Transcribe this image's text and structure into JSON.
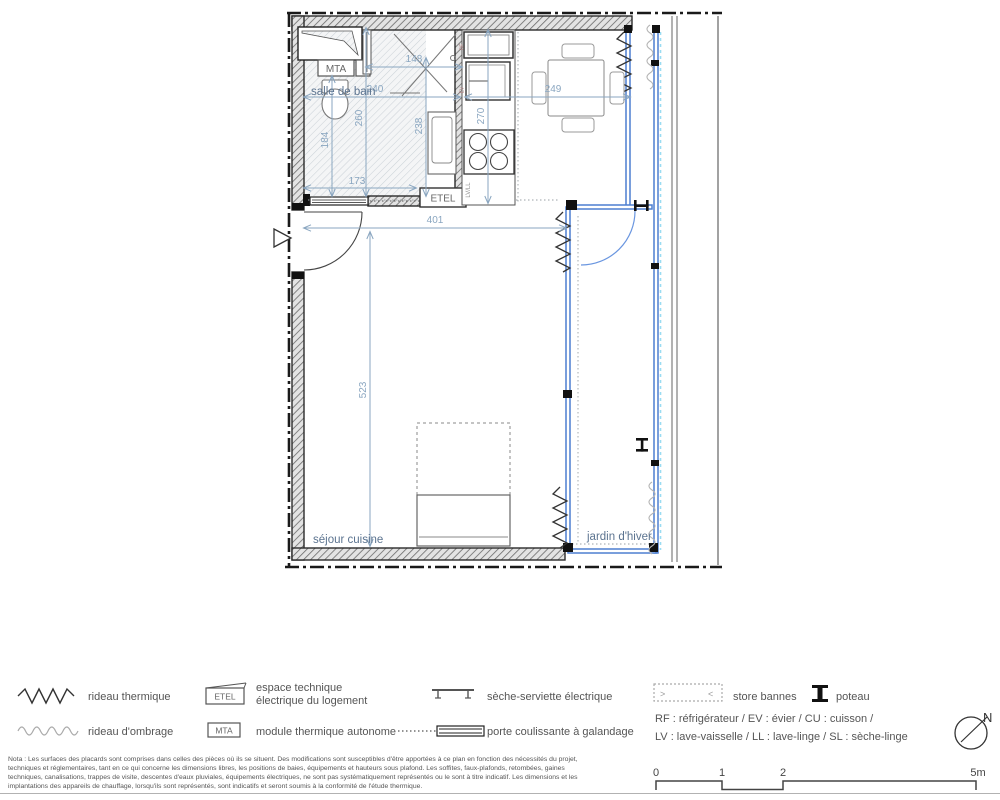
{
  "plan": {
    "rooms": {
      "bathroom": "salle de bain",
      "living": "séjour cuisine",
      "winter_garden": "jardin d'hiver"
    },
    "boxes": {
      "mta": "MTA",
      "etel": "ETEL"
    },
    "appliances": {
      "lvll": "LV/LL",
      "rf": "RF",
      "ev": "EV"
    },
    "dimensions": {
      "d148": "148",
      "d240": "240",
      "d259": "249",
      "d260": "260",
      "d238": "238",
      "d270": "270",
      "d184": "184",
      "d173": "173",
      "d401": "401",
      "d523": "523"
    }
  },
  "legend": {
    "rideau_thermique": "rideau thermique",
    "rideau_ombrage": "rideau d'ombrage",
    "etel_label": "ETEL",
    "etel_desc_line1": "espace technique",
    "etel_desc_line2": "électrique du logement",
    "mta_label": "MTA",
    "mta_desc": "module thermique autonome",
    "seche_serviette": "sèche-serviette électrique",
    "porte_coulissante": "porte coulissante à galandage",
    "store_bannes": "store bannes",
    "store_arrow_left": ">",
    "store_arrow_right": "<",
    "poteau": "poteau",
    "abbrev_line1": "RF : réfrigérateur / EV : évier / CU : cuisson /",
    "abbrev_line2": "LV : lave-vaisselle / LL : lave-linge / SL : sèche-linge"
  },
  "scalebar": {
    "t0": "0",
    "t1": "1",
    "t2": "2",
    "t5": "5m"
  },
  "north": {
    "label": "N"
  },
  "nota": {
    "line1": "Nota : Les surfaces des placards sont comprises dans celles des pièces où ils se situent. Des modifications sont susceptibles d'être apportées à ce plan en fonction des nécessités du projet,",
    "line2": "techniques et réglementaires, tant en ce qui concerne les dimensions libres, les positions de baies, équipements et hauteurs sous plafond. Les soffites, faux-plafonds, retombées, gaines",
    "line3": "techniques, canalisations, trappes de visite, descentes d'eaux pluviales, équipements électriques, ne sont pas systématiquement représentés ou le sont à titre indicatif. Les dimensions et les",
    "line4": "implantations des appareils de chauffage, lorsqu'ils sont représentés, sont indicatifs et seront soumis à la conformité de l'étude thermique."
  },
  "colors": {
    "dimension": "#8aa6c0",
    "glazing": "#4d7fd0",
    "store_track_cyan": "#9adcf2",
    "wall_line": "#2b2b2b",
    "room_label": "#5c7490"
  }
}
